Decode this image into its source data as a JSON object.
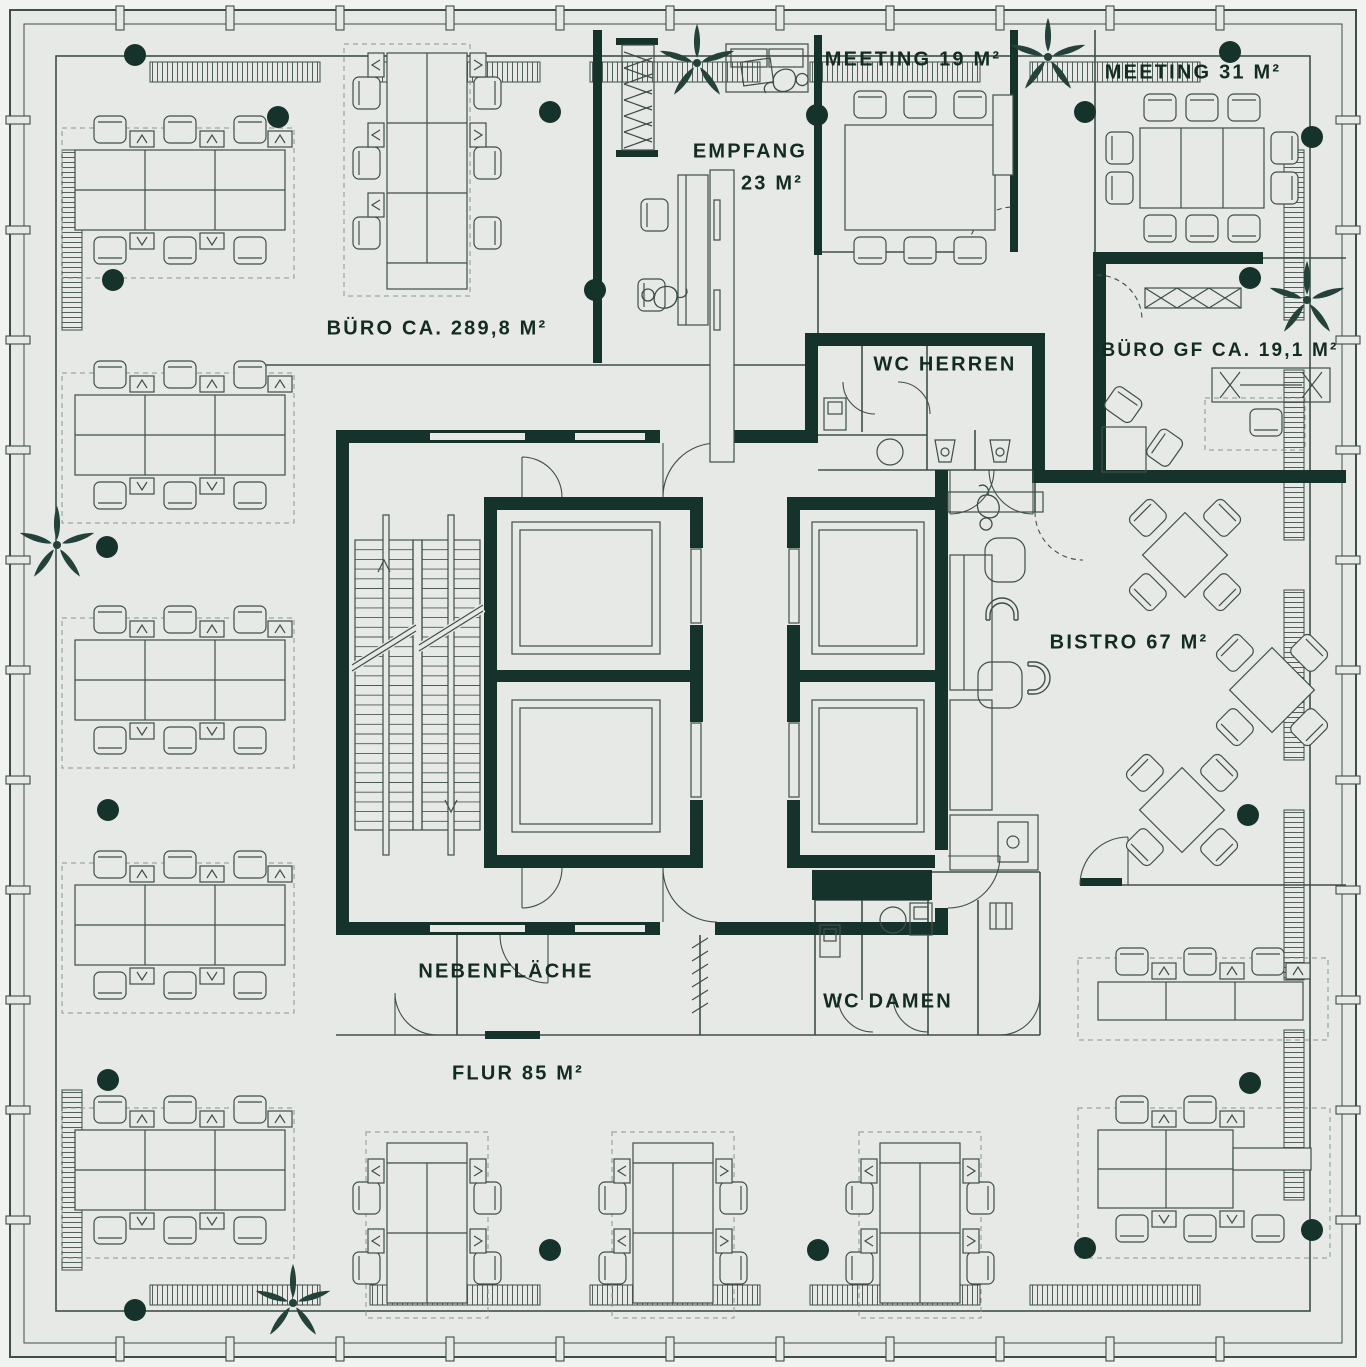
{
  "plan": {
    "rooms": {
      "buero": {
        "label": "BÜRO CA. 289,8 M²"
      },
      "empfang": {
        "label": "EMPFANG",
        "area": "23 M²"
      },
      "meeting19": {
        "label": "MEETING 19 M²"
      },
      "meeting31": {
        "label": "MEETING 31 M²"
      },
      "buero_gf": {
        "label": "BÜRO GF CA. 19,1 M²"
      },
      "wc_herren": {
        "label": "WC HERREN"
      },
      "bistro": {
        "label": "BISTRO 67 M²"
      },
      "nebenflaeche": {
        "label": "NEBENFLÄCHE"
      },
      "wc_damen": {
        "label": "WC DAMEN"
      },
      "flur": {
        "label": "FLUR 85 M²"
      }
    },
    "colors": {
      "wall": "#16332b",
      "floor": "#e6e9e6",
      "outer_bg": "#f1f3f0",
      "line": "#3f4f48",
      "dashed": "#8a968f",
      "text": "#132b22",
      "plant": "#24423a"
    },
    "icons": {
      "plant": "potted-plant-icon",
      "column": "column-marker",
      "stairs": "staircase-icon",
      "elevator": "elevator-icon",
      "person": "person-figure-icon"
    }
  }
}
